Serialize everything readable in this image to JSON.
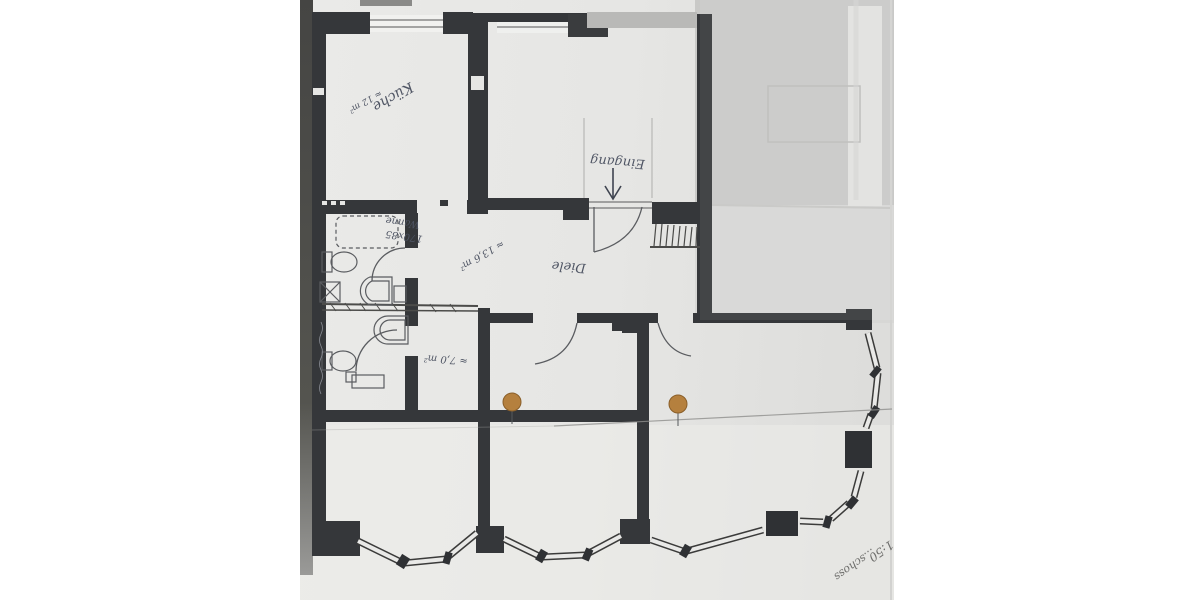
{
  "document": {
    "kind_label": "Grundriss",
    "scale_text": "1:50",
    "title_fragment": "...schoss"
  },
  "rooms": {
    "kueche": {
      "label": "Küche",
      "area": "≈ 12 m²"
    },
    "diele": {
      "label": "Diele",
      "area": "≈ 13,6 m²"
    },
    "eingang": {
      "label": "Eingang"
    },
    "bad": {
      "note_line1": "Wanne",
      "note_line2": "170x85"
    },
    "kammer": {
      "area": "≈ 7,0 m²"
    }
  },
  "markers": {
    "orange_dot_count": 2
  },
  "colors": {
    "paper": "#e7e7e5",
    "paper_wash": "#c9c9c7",
    "wall": "#35373a",
    "pencil_ink": "#4f5564",
    "graphite": "#6e6e6c",
    "marker_dot": "#b5803e",
    "page_edge": "#4a4a48"
  }
}
